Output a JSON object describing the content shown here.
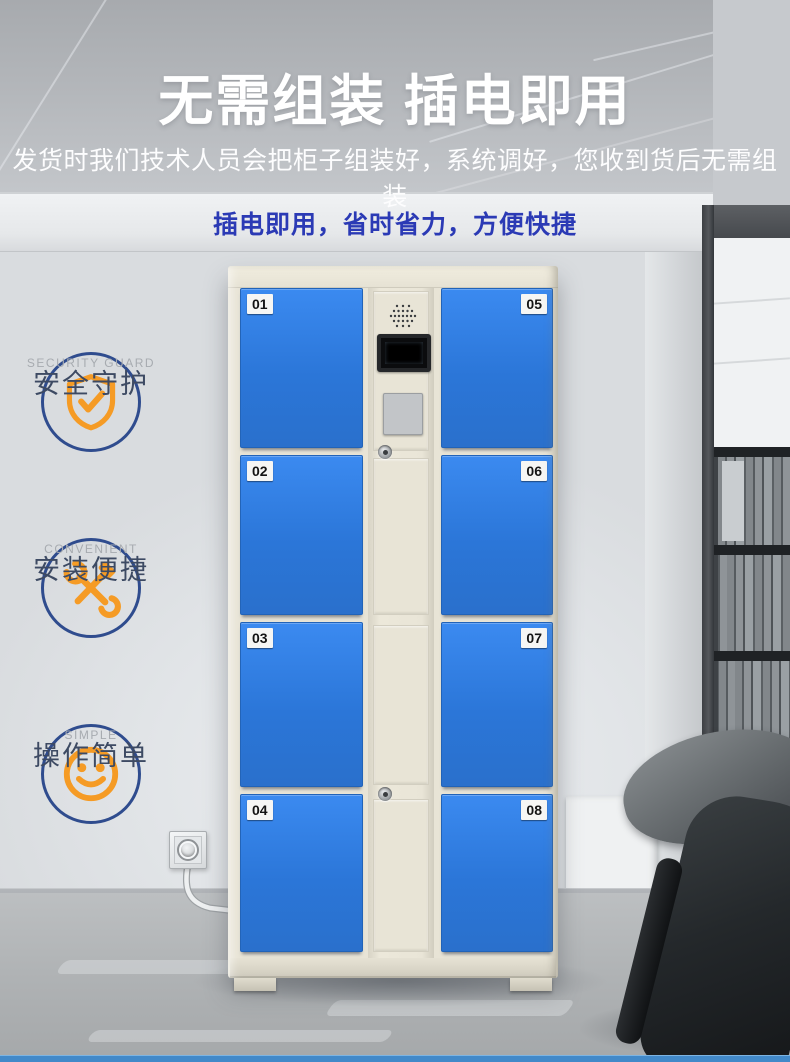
{
  "header": {
    "title": "无需组装 插电即用",
    "subtitle": "发货时我们技术人员会把柜子组装好，系统调好，您收到货后无需组装",
    "tagline": "插电即用，省时省力，方便快捷"
  },
  "features": [
    {
      "icon": "shield-check-icon",
      "label": "安全守护",
      "caption": "SECURITY GUARD"
    },
    {
      "icon": "wrench-hammer-icon",
      "label": "安装便捷",
      "caption": "CONVENIENT"
    },
    {
      "icon": "smiley-face-icon",
      "label": "操作简单",
      "caption": "SIMPLE"
    }
  ],
  "locker": {
    "left_doors": [
      "01",
      "02",
      "03",
      "04"
    ],
    "right_doors": [
      "05",
      "06",
      "07",
      "08"
    ]
  },
  "colors": {
    "door_blue": "#2e7dde",
    "cabinet_cream": "#e8e4d6",
    "accent_orange": "#f59b25",
    "ring_navy": "#2f4c8e",
    "tagline_blue": "#2b3ab5",
    "bottom_strip_blue": "#4289c9"
  }
}
